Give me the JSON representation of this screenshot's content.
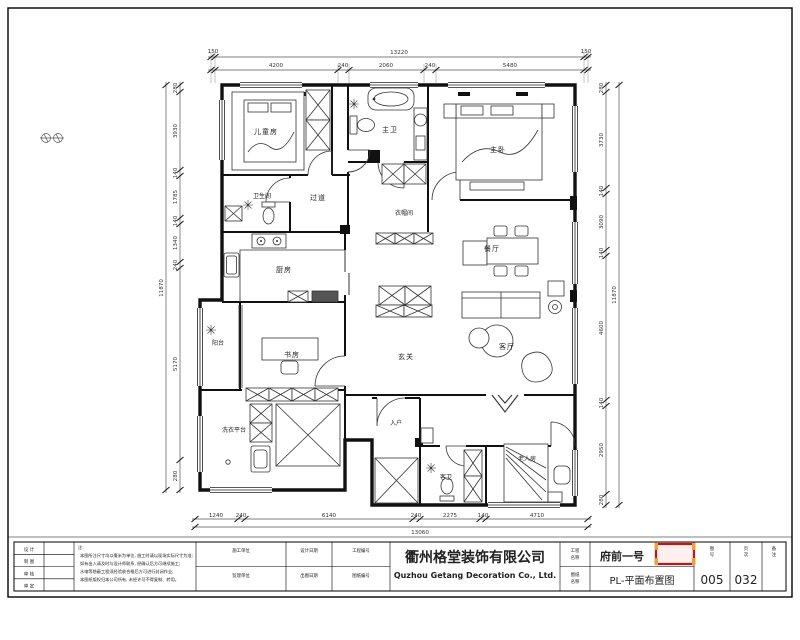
{
  "ui": {
    "selection_box": {
      "border_color": "#cc1111",
      "fill_color": "#fdf0ef",
      "handle_color": "#e8a23c"
    }
  },
  "floorplan": {
    "rooms": {
      "kids_room": "儿童房",
      "master_bath": "主卫",
      "master_bedroom": "主卧",
      "closet": "衣帽间",
      "guest_bath": "卫生间",
      "hallway": "过道",
      "kitchen": "厨房",
      "balcony": "阳台",
      "study": "书房",
      "foyer": "玄关",
      "dining": "餐厅",
      "living": "客厅",
      "laundry": "洗衣平台",
      "entry": "入户",
      "elder_room": "老人房",
      "second_bath": "客卫"
    },
    "dims": {
      "top": {
        "overall": "13220",
        "end_left": "150",
        "end_right": "150",
        "segments": [
          "4200",
          "240",
          "2060",
          "240",
          "5480"
        ]
      },
      "bottom": {
        "overall": "13060",
        "segments": [
          "1240",
          "240",
          "6140",
          "240",
          "2275",
          "140",
          "4710"
        ]
      },
      "left": {
        "overall": "11870",
        "segments": [
          "280",
          "3930",
          "140",
          "1785",
          "140",
          "1340",
          "240",
          "5170",
          "280"
        ]
      },
      "right": {
        "overall": "11870",
        "segments": [
          "280",
          "3730",
          "140",
          "3090",
          "140",
          "4600",
          "140",
          "2950",
          "280"
        ]
      }
    }
  },
  "title_block": {
    "company": {
      "cn": "衢州格堂装饰有限公司",
      "en": "Quzhou Getang Decoration Co., Ltd."
    },
    "sign_rows": [
      "设 计",
      "制 图",
      "审 核",
      "审 定"
    ],
    "notes": {
      "label": "注:",
      "line1": "本图所注尺寸均以毫米为单位, 施工时请以现场实际尺寸为准;",
      "line2": "如有出入请及时与设计师联系, 经确认后方可继续施工;",
      "line3": "水电等隐蔽工程须经验收合格后方可进行封闭作业;",
      "line4": "本图纸版权归本公司所有, 未经许可不得复制、转用。"
    },
    "mid_cells": {
      "r1c1": "施工单位",
      "r2c1": "监理单位",
      "r1c2": "设计日期",
      "r2c2": "出图日期",
      "r1c3": "工程编号",
      "r2c3": "图纸编号"
    },
    "project": {
      "label_l1": "工程",
      "label_l2": "名称",
      "value": "府前一号"
    },
    "drawing": {
      "label_l1": "图纸",
      "label_l2": "名称",
      "value": "PL-平面布置图"
    },
    "sheet": {
      "label_l1": "图",
      "label_l2": "号",
      "value": "005"
    },
    "page": {
      "label_l1": "页",
      "label_l2": "次",
      "value": "032"
    },
    "remark": {
      "label_l1": "备",
      "label_l2": "注",
      "value": ""
    }
  }
}
